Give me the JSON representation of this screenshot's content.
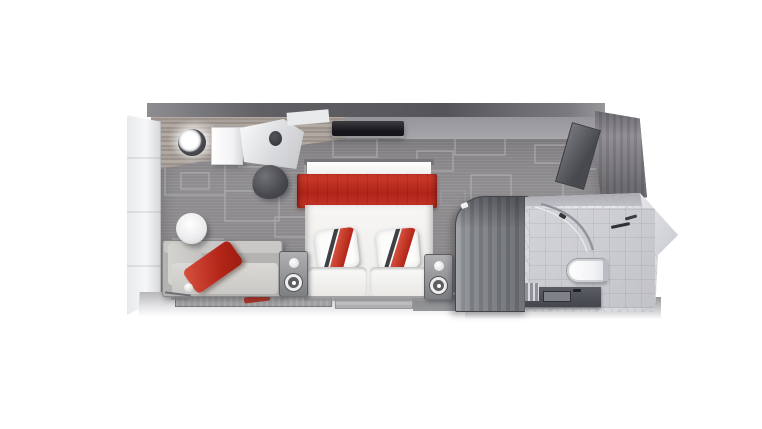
{
  "scene": {
    "kind": "3D top-down floor plan rendering",
    "subject": "Cruise ship stateroom: sitting area, vanity, double bed and marble bathroom",
    "palette": {
      "background": "#ffffff",
      "accent_red": "#bf2a1d",
      "carpet_gray": "#8b898b",
      "wall_light": "#f3f4f6",
      "wood_gray": "#a39a94",
      "wardrobe_gray": "#83868b",
      "marble_light": "#d7d8dc",
      "counter_dark": "#53565d",
      "tv_black": "#1e1f23"
    },
    "items": {
      "left_wall": {
        "label": "Left cabin wall panels"
      },
      "top_wall": {
        "label": "Back wall"
      },
      "right_wall": {
        "label": "Entry wall (wood planks)"
      },
      "entry_door": {
        "label": "Open cabin entry door"
      },
      "carpet": {
        "label": "Patterned gray carpet"
      },
      "vanity_light": {
        "label": "Round ceiling light"
      },
      "cabinet": {
        "label": "White cabinet / minibar"
      },
      "vanity_counter": {
        "label": "Vanity desk counter"
      },
      "vanity_chair": {
        "label": "Dark vanity stool"
      },
      "tv": {
        "label": "Wall-mounted flat TV"
      },
      "bed": {
        "label": "Double bed with red throw blanket"
      },
      "pillow_left": {
        "label": "Left pillow with red sash"
      },
      "pillow_right": {
        "label": "Right pillow with red sash"
      },
      "nightstand_left": {
        "label": "Left bedside table with lamp"
      },
      "nightstand_right": {
        "label": "Right bedside table with lamp"
      },
      "sofa": {
        "label": "Gray sofa with red cushion"
      },
      "side_table": {
        "label": "Round white side table"
      },
      "rug": {
        "label": "Area rug with red detail"
      },
      "wardrobe": {
        "label": "Curved wardrobe unit"
      },
      "bathroom": {
        "label": "Marble bathroom"
      },
      "toilet": {
        "label": "Toilet"
      },
      "sink": {
        "label": "Sink vanity counter"
      },
      "shower": {
        "label": "Curved glass shower"
      }
    }
  }
}
